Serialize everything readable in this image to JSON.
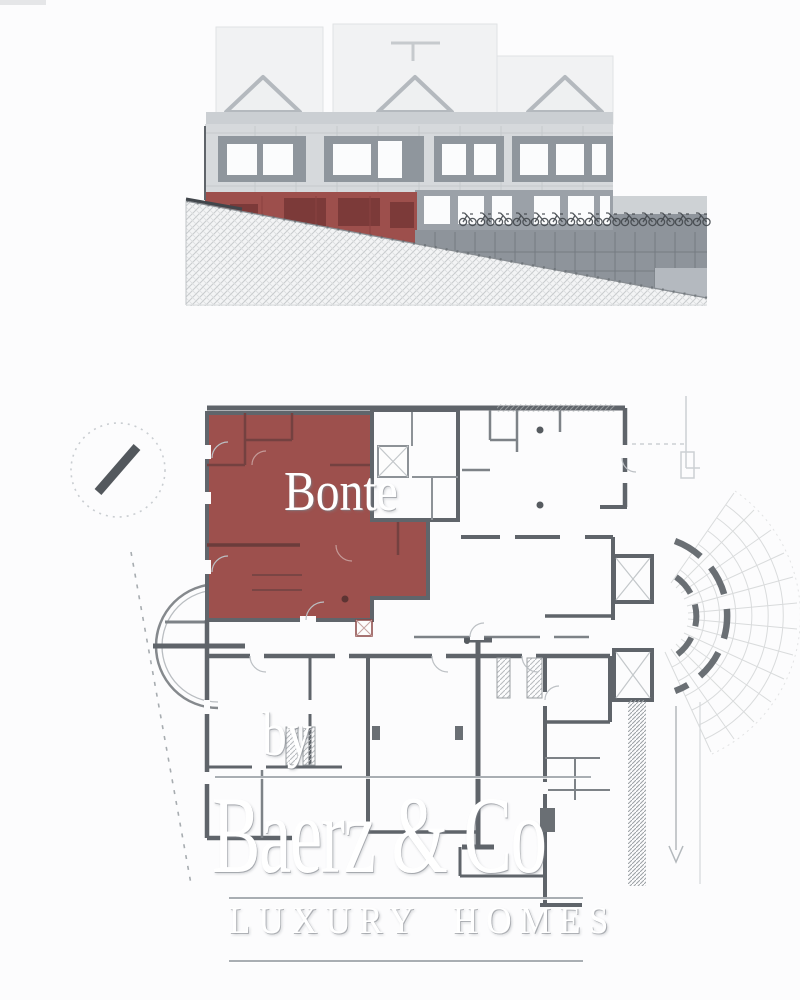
{
  "watermark": {
    "agent_name": "Bonte",
    "by_label": "by",
    "brand_name": "Baerz & Co",
    "tagline": "LUXURY HOMES"
  },
  "colors": {
    "unit_highlight_red": "#9d504d",
    "elevation_highlight_red": "#9d4f4c",
    "wall_gray": "#5f646a",
    "facade_gray": "#d6d9dc",
    "storefront_gray": "#8e949b",
    "roof_light_gray": "#f1f2f3",
    "watermark_white": "#ffffff",
    "background": "#fcfcfd"
  }
}
